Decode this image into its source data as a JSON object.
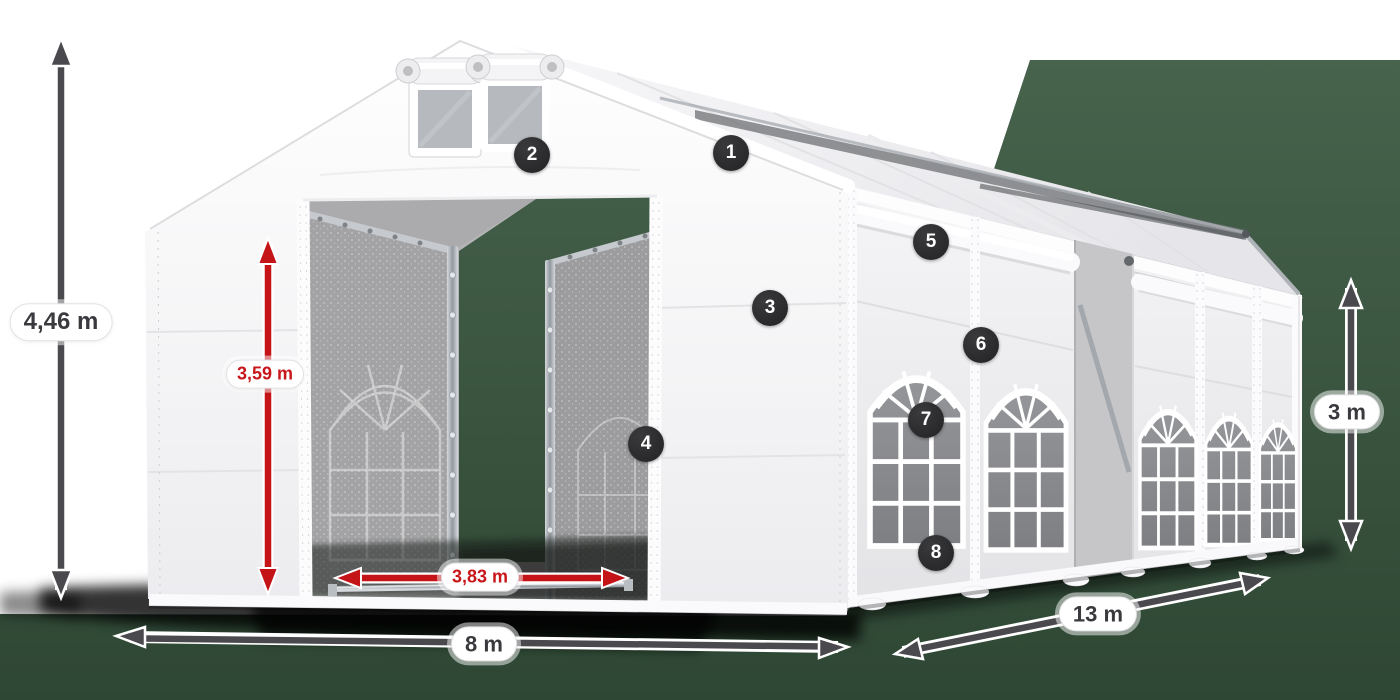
{
  "dimension_labels": {
    "total_height": "4,46 m",
    "door_height": "3,59 m",
    "door_width": "3,83 m",
    "width": "8 m",
    "length": "13 m",
    "side_height": "3 m"
  },
  "feature_markers": [
    {
      "number": "1"
    },
    {
      "number": "2"
    },
    {
      "number": "3"
    },
    {
      "number": "4"
    },
    {
      "number": "5"
    },
    {
      "number": "6"
    },
    {
      "number": "7"
    },
    {
      "number": "8"
    }
  ],
  "colors": {
    "dimension_arrow_gray": "#4a4a4e",
    "dimension_arrow_red": "#c41418",
    "label_text_dark": "#3a3a3e",
    "label_text_red": "#c8161b",
    "backdrop_green": "#3c5943",
    "marker_background": "#2b2b2d",
    "tent_white": "#ffffff"
  }
}
